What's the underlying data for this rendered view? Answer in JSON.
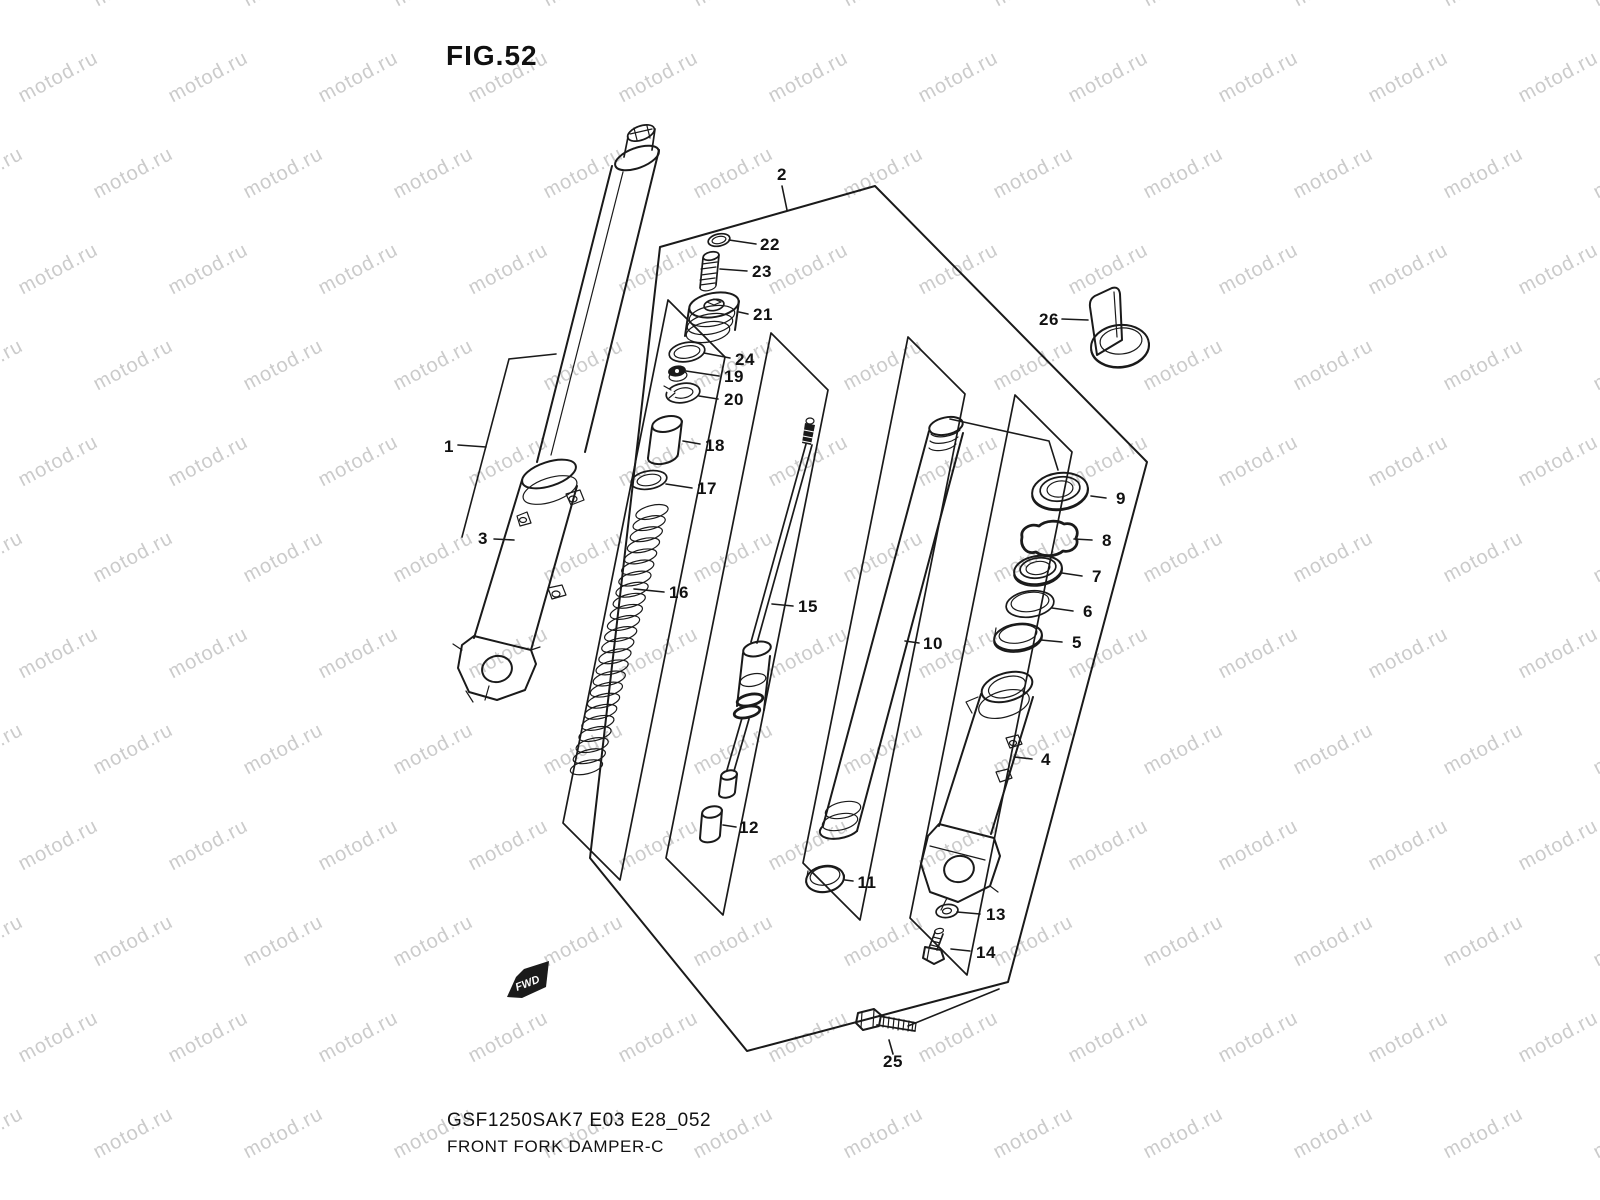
{
  "title": "FIG.52",
  "watermark": {
    "text": "motod.ru",
    "color": "#cbcbcb"
  },
  "figure": {
    "type": "exploded-parts-diagram",
    "fwd_label": "FWD",
    "callouts": [
      "1",
      "2",
      "3",
      "4",
      "5",
      "6",
      "7",
      "8",
      "9",
      "10",
      "11",
      "12",
      "13",
      "14",
      "15",
      "16",
      "17",
      "18",
      "19",
      "20",
      "21",
      "22",
      "23",
      "24",
      "25",
      "26"
    ]
  },
  "footer": {
    "code": "GSF1250SAK7 E03 E28_052",
    "caption": "FRONT FORK DAMPER-C"
  },
  "colors": {
    "background": "#ffffff",
    "line": "#1a1a1a",
    "watermark": "#cbcbcb",
    "text": "#111111"
  }
}
